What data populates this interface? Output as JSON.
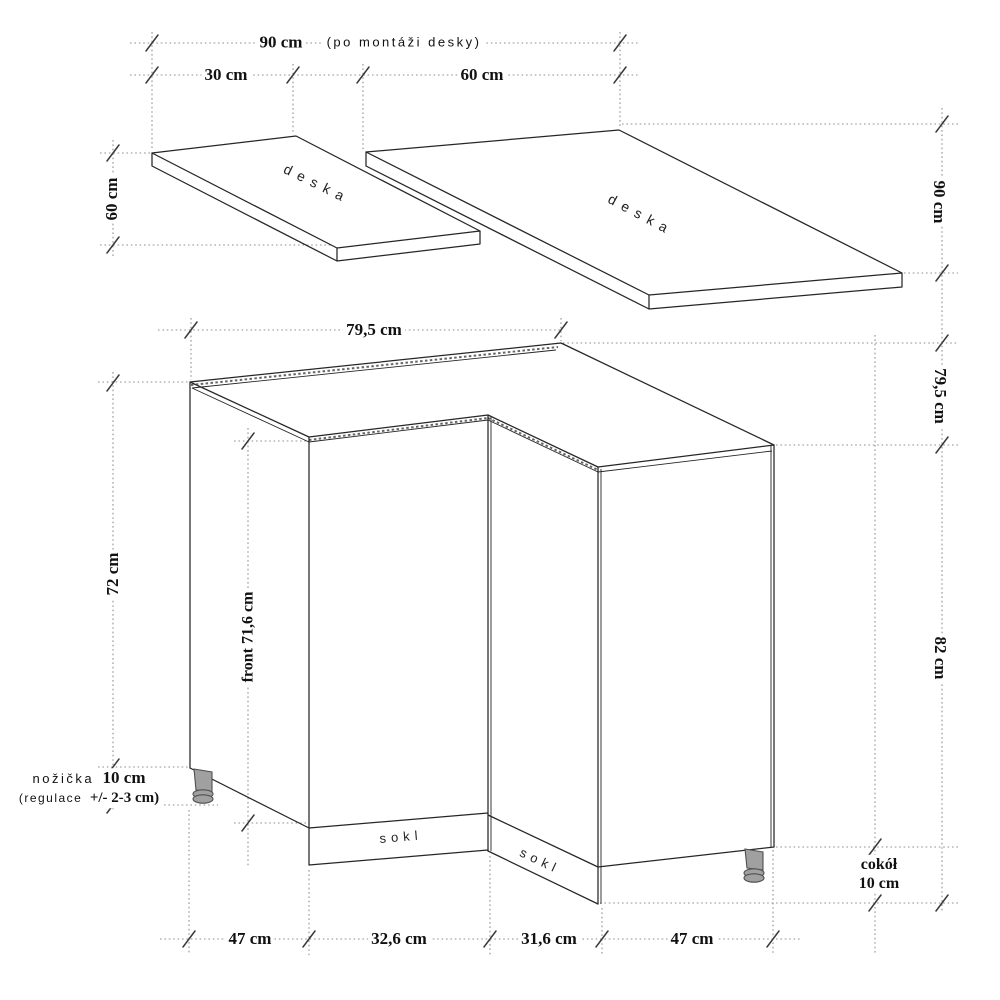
{
  "colors": {
    "line": "#262626",
    "dotted": "#8f8f8f",
    "tick": "#3a3a3a",
    "leg_fill": "#a0a0a0",
    "leg_stroke": "#4f4f4f",
    "text": "#111111",
    "background": "#ffffff"
  },
  "countertops": {
    "left_board_label": "deska",
    "right_board_label": "deska",
    "total_width": {
      "value": "90 cm",
      "note": "(po montáži desky)"
    },
    "left_board_width": "30 cm",
    "right_board_width": "60 cm",
    "left_board_depth": "60 cm",
    "right_board_depth": "90 cm"
  },
  "cabinet": {
    "top_width": "79,5 cm",
    "top_depth_right": "79,5 cm",
    "carcass_height_left": "72 cm",
    "front_height": "front 71,6 cm",
    "total_height_right": "82 cm",
    "leg": {
      "name": "nožička",
      "height": "10 cm",
      "note_prefix": "(regulace",
      "note_value": "+/- 2-3 cm)"
    },
    "plinth_left_label": "sokl",
    "plinth_right_label": "sokl",
    "plinth_dim": {
      "line1": "cokół",
      "line2": "10 cm"
    },
    "bottom_dims": [
      "47 cm",
      "32,6 cm",
      "31,6 cm",
      "47 cm"
    ]
  }
}
